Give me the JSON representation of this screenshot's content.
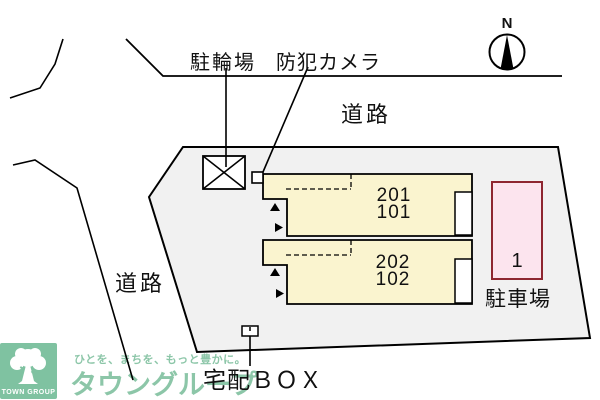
{
  "plan": {
    "north": "N",
    "labels": {
      "bicycle_parking": "駐輪場",
      "security_camera": "防犯カメラ",
      "road_top": "道路",
      "road_left": "道路",
      "delivery_box": "宅配ＢＯＸ",
      "parking_area": "駐車場",
      "parking_space_1": "1"
    },
    "units": {
      "building_a_upper": "201",
      "building_a_lower": "101",
      "building_b_upper": "202",
      "building_b_lower": "102"
    }
  },
  "logo": {
    "tagline": "ひとを、まちを、もっと豊かに。",
    "brand": "タウングループ",
    "badge": "TOWN GROUP"
  },
  "colors": {
    "background": "#ffffff",
    "outline": "#000000",
    "lot_fill": "#f1f1f1",
    "building_fill": "#faf4cf",
    "inset_fill": "#ffffff",
    "parking_fill": "#fce4ee",
    "parking_stroke": "#8e2630",
    "logo_bg": "#7fc2a1",
    "logo_text": "#8cc6a8"
  }
}
